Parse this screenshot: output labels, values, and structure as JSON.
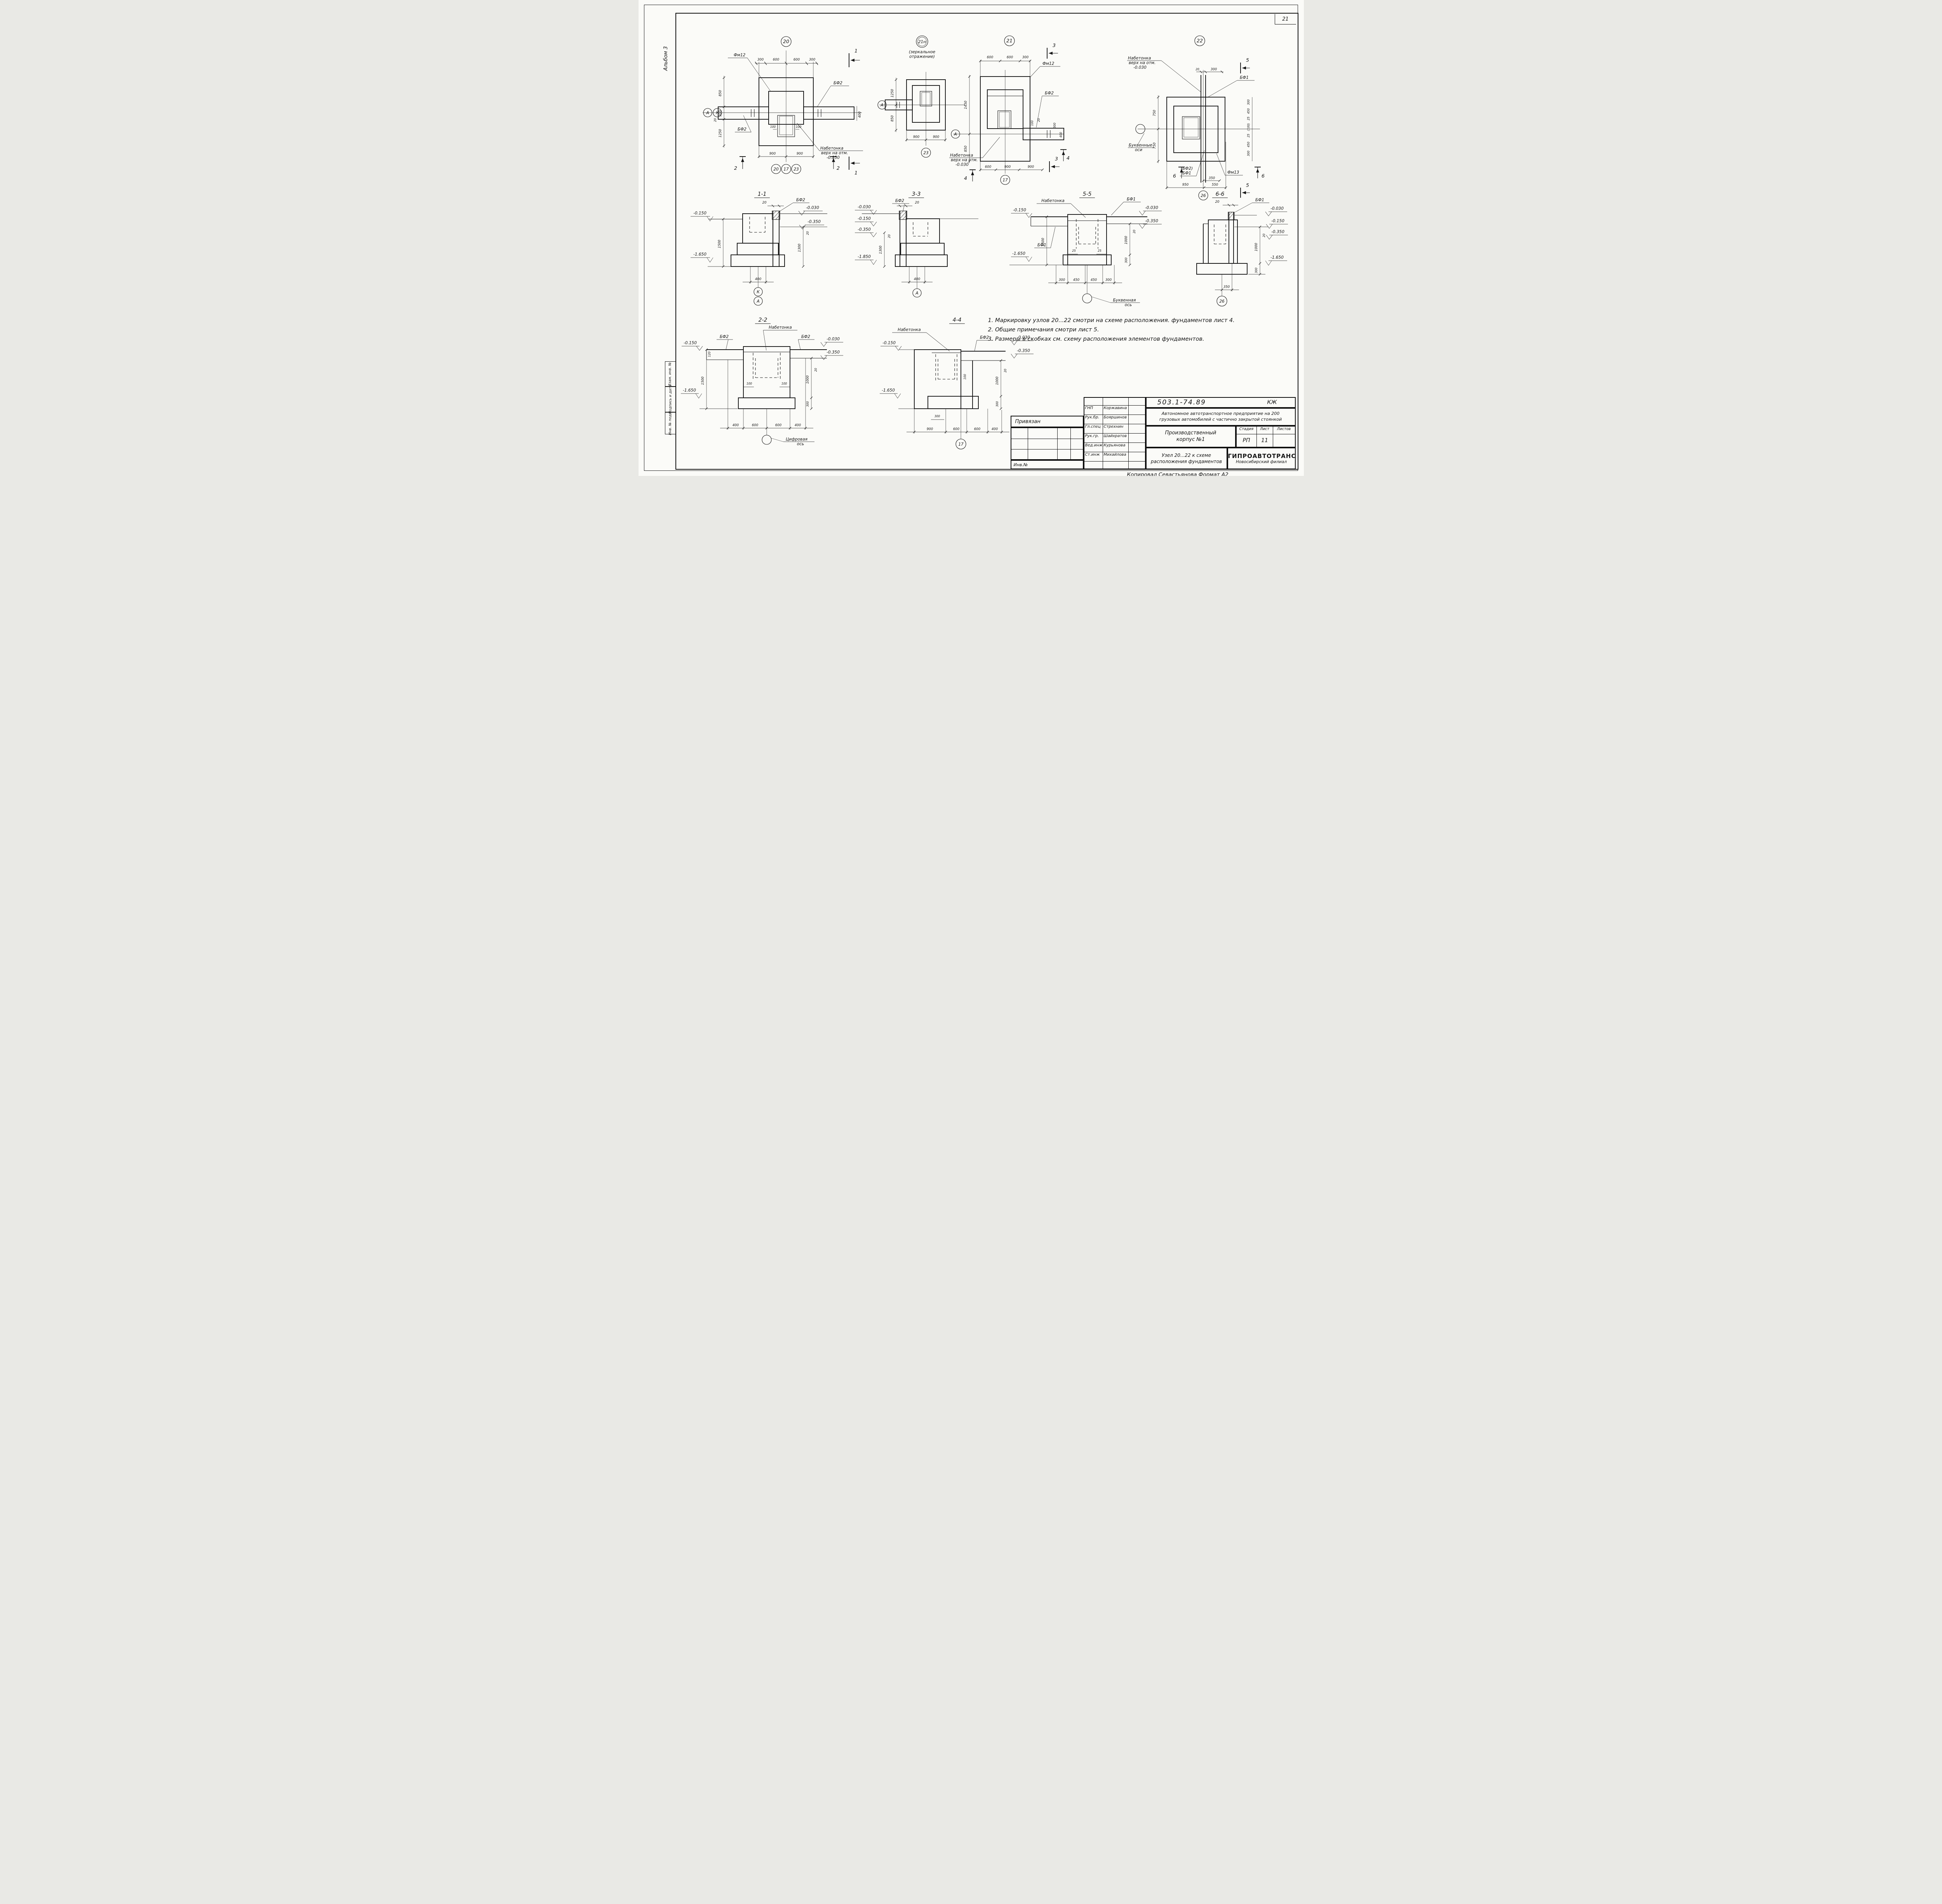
{
  "page": {
    "sheet_number": "21",
    "album": "Альбом 3",
    "copied": "Копировал Севастьянова  Формат А2"
  },
  "frame": {
    "v1": "Взам. инв. №",
    "v2": "Подпись и дата",
    "v3": "Инв. № подл."
  },
  "lbl": {
    "nab1": "Набетонка",
    "nab2": "верх на отм.",
    "nab3": "-0.030",
    "nabetonka": "Набетонка",
    "bf1": "БФ1",
    "bf2": "БФ2",
    "bf2p": "(БФ2)",
    "fm12": "Фм12",
    "fm13": "Фм13",
    "letter_axes1": "Буквенные",
    "letter_axes2": "оси",
    "letter_axis1": "Буквенная",
    "letter_axis2": "ось",
    "digit_axis1": "Цифровая",
    "digit_axis2": "ось"
  },
  "node20": {
    "circle": "20",
    "dt": [
      "300",
      "600",
      "600",
      "300"
    ],
    "db": [
      "900",
      "900"
    ],
    "dl": [
      "850",
      "300",
      "20",
      "1250"
    ],
    "dr": "400",
    "di": [
      "100",
      "100"
    ],
    "axA": "А",
    "axK": "К",
    "bc": [
      "20",
      "17",
      "23"
    ],
    "mk1": "1",
    "mk2": "2"
  },
  "node21n": {
    "circle": "21н",
    "note1": "(зеркальное",
    "note2": "отражение)",
    "axA": "А",
    "dl": [
      "1250",
      "850"
    ],
    "db": [
      "900",
      "900"
    ],
    "bc": "23"
  },
  "node21": {
    "circle": "21",
    "dt": [
      "600",
      "600",
      "300"
    ],
    "dl": [
      "1450",
      "850"
    ],
    "dr": [
      "100",
      "20",
      "300",
      "400"
    ],
    "db": [
      "600",
      "900",
      "900"
    ],
    "bc": "17",
    "axA": "А",
    "mk3": "3",
    "mk4": "4"
  },
  "node22": {
    "circle": "22",
    "dt": [
      "20",
      "300"
    ],
    "dl": [
      "750",
      "750"
    ],
    "dr": [
      "300",
      "450",
      "25",
      "(100)",
      "25",
      "450",
      "300"
    ],
    "d350": "350",
    "db": [
      "950",
      "550"
    ],
    "bc": "26",
    "mk5": "5",
    "mk6": "6"
  },
  "sec11": {
    "title": "1-1",
    "d20": "20",
    "m015": "-0.150",
    "m003": "-0.030",
    "m035": "-0.350",
    "m165": "-1.650",
    "d1500": "1500",
    "d1300": "1300",
    "dr20": "20",
    "d400": "400",
    "axK": "К",
    "axA": "А"
  },
  "sec33": {
    "title": "3-3",
    "d20": "20",
    "m003": "-0.030",
    "m015": "-0.150",
    "m035": "-0.350",
    "m185": "-1.850",
    "d1300": "1300",
    "dl20": "20",
    "d400": "400",
    "axA": "А"
  },
  "sec55": {
    "title": "5-5",
    "m015": "-0.150",
    "m003": "-0.030",
    "m035": "-0.350",
    "m165": "-1.650",
    "d1500": "1500",
    "di": [
      "25",
      "25"
    ],
    "d1000": "1000",
    "dr20": "20",
    "d300": "300",
    "db": [
      "300",
      "450",
      "450",
      "300"
    ]
  },
  "sec66": {
    "title": "6-6",
    "d20": "20",
    "m003": "-0.030",
    "m015": "-0.150",
    "m035": "-0.350",
    "m165": "-1.650",
    "d1000": "1000",
    "dr20": "20",
    "d300": "300",
    "d350": "350",
    "bc": "26"
  },
  "sec22": {
    "title": "2-2",
    "m015": "-0.150",
    "m003": "-0.030",
    "m035": "-0.350",
    "m165": "-1.650",
    "d120": "120",
    "d1500": "1500",
    "di": [
      "100",
      "100"
    ],
    "d1000": "1000",
    "dr20": "20",
    "d300": "300",
    "db": [
      "400",
      "600",
      "600",
      "400"
    ]
  },
  "sec44": {
    "title": "4-4",
    "m015": "-0.150",
    "m003": "-0.030",
    "m035": "-0.350",
    "m165": "-1.650",
    "d100": "100",
    "d300s": "300",
    "d1000": "1000",
    "dr20": "20",
    "d300": "300",
    "db": [
      "900",
      "600",
      "600",
      "400"
    ],
    "bc": "17"
  },
  "notes": {
    "n1": "1. Маркировку узлов 20...22 смотри на схеме расположения. фундаментов лист 4.",
    "n2": "2. Общие примечания смотри лист 5.",
    "n3": "3. Размеры в скобках см. схему расположения элементов фундаментов."
  },
  "stamp": {
    "doc": "503.1-74.89",
    "mark": "КЖ",
    "project1": "Автономное автотранспортное предприятие на 200",
    "project2": "грузовых автомобилей с частично закрытой стоянкой",
    "object1": "Производственный",
    "object2": "корпус №1",
    "title1": "Узел 20...22 к схеме",
    "title2": "расположения фундаментов",
    "org": "ГИПРОАВТОТРАНС",
    "branch": "Новосибирский филиал",
    "h_stage": "Стадия",
    "h_sheet": "Лист",
    "h_sheets": "Листов",
    "stage": "РП",
    "sheet": "11",
    "sheets": "",
    "attached": "Привязан",
    "inv": "Инв.№",
    "staff": [
      {
        "role": "ГНП",
        "name": "Коржавина"
      },
      {
        "role": "Рук.бр.",
        "name": "Бояршинов"
      },
      {
        "role": "Гл.спец",
        "name": "Стрехнин"
      },
      {
        "role": "Рук.гр.",
        "name": "Шайхратов"
      },
      {
        "role": "Вед.инж",
        "name": "Курьянова"
      },
      {
        "role": "Ст.инж",
        "name": "Михайлова"
      }
    ]
  }
}
